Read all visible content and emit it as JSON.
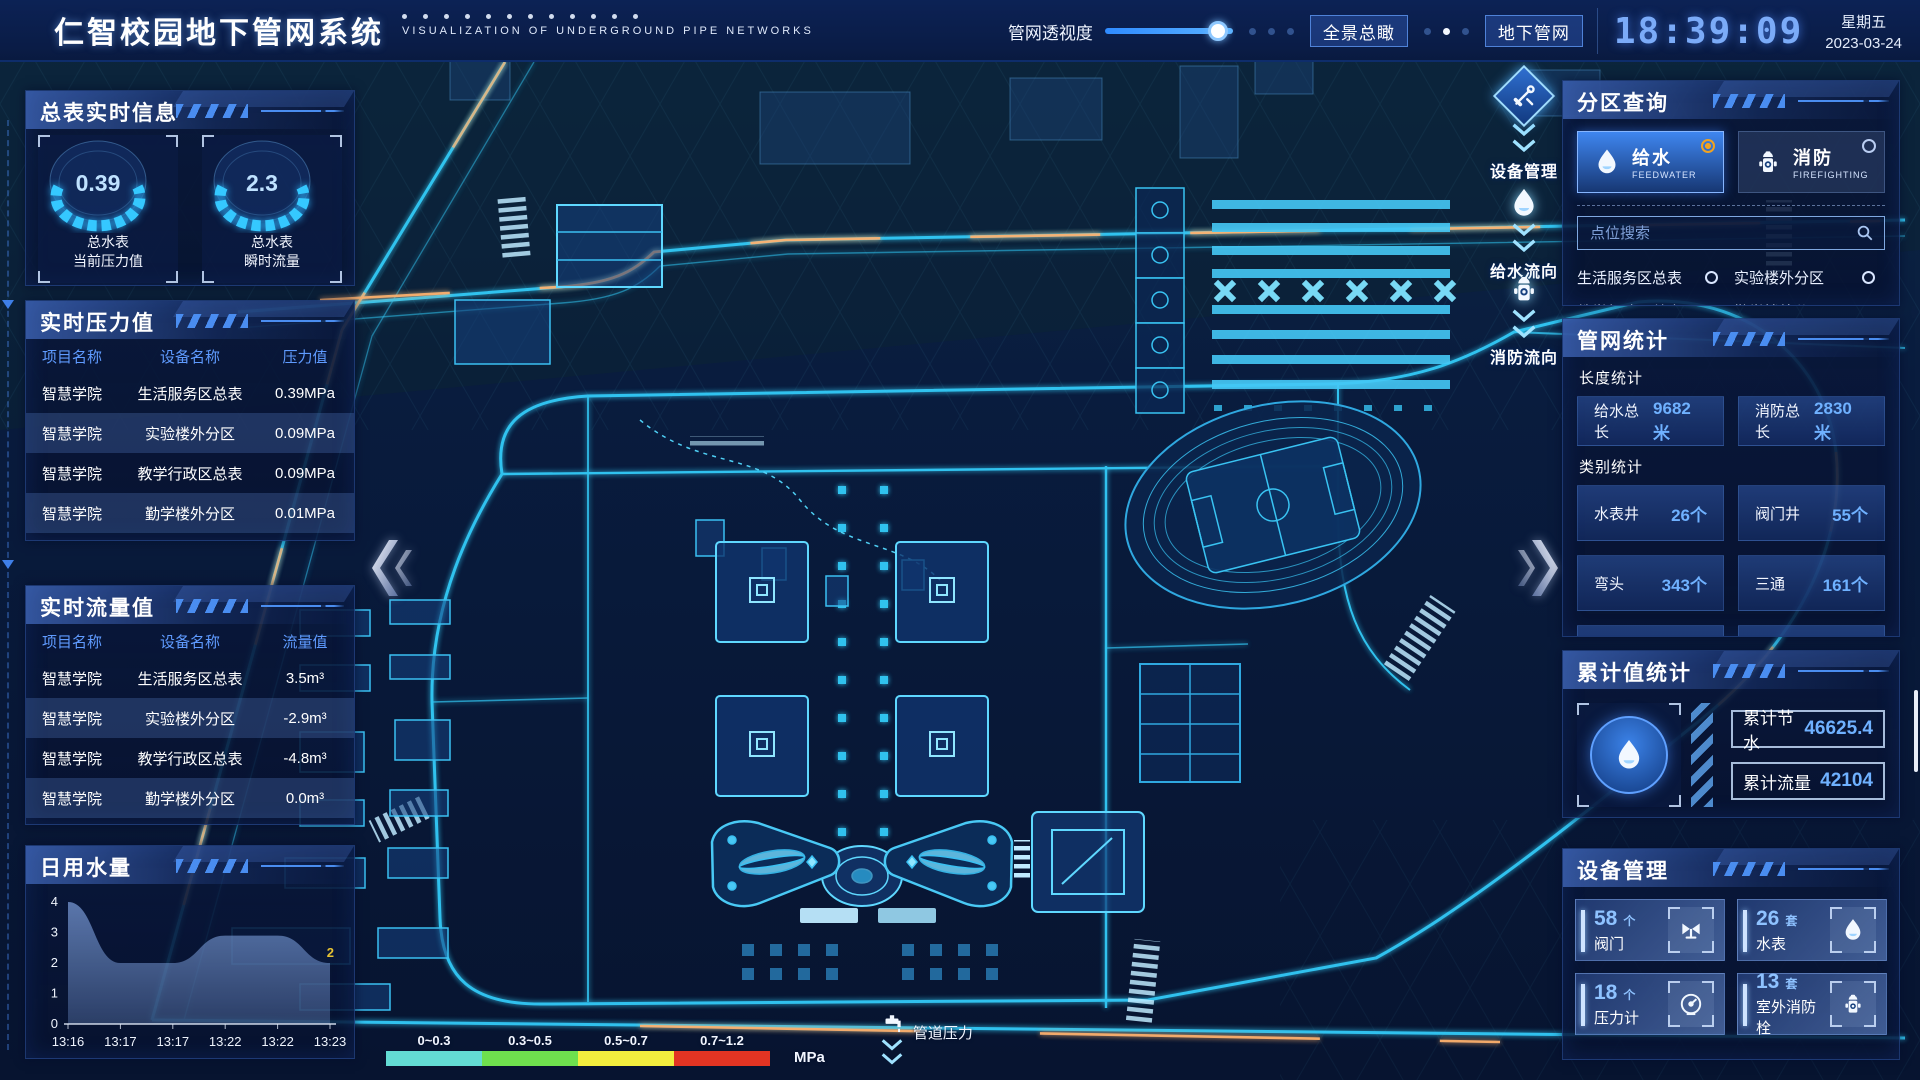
{
  "header": {
    "title": "仁智校园地下管网系统",
    "subtitle": "VISUALIZATION OF UNDERGROUND PIPE NETWORKS",
    "slider": {
      "label": "管网透视度",
      "percent": 88
    },
    "buttons": [
      {
        "label": "全景总瞰"
      },
      {
        "label": "地下管网"
      }
    ],
    "time": "18:39:09",
    "weekday": "星期五",
    "date": "2023-03-24"
  },
  "left": {
    "realtime_info": {
      "title": "总表实时信息",
      "gauges": [
        {
          "value": "0.39",
          "label1": "总水表",
          "label2": "当前压力值"
        },
        {
          "value": "2.3",
          "label1": "总水表",
          "label2": "瞬时流量"
        }
      ]
    },
    "pressure": {
      "title": "实时压力值",
      "headers": [
        "项目名称",
        "设备名称",
        "压力值"
      ],
      "rows": [
        [
          "智慧学院",
          "生活服务区总表",
          "0.39MPa"
        ],
        [
          "智慧学院",
          "实验楼外分区",
          "0.09MPa"
        ],
        [
          "智慧学院",
          "教学行政区总表",
          "0.09MPa"
        ],
        [
          "智慧学院",
          "勤学楼外分区",
          "0.01MPa"
        ],
        [
          "智慧学院",
          "砺学楼外分区",
          "0.02MPa"
        ]
      ]
    },
    "flow": {
      "title": "实时流量值",
      "headers": [
        "项目名称",
        "设备名称",
        "流量值"
      ],
      "rows": [
        [
          "智慧学院",
          "生活服务区总表",
          "3.5m³"
        ],
        [
          "智慧学院",
          "实验楼外分区",
          "-2.9m³"
        ],
        [
          "智慧学院",
          "教学行政区总表",
          "-4.8m³"
        ],
        [
          "智慧学院",
          "勤学楼外分区",
          "0.0m³"
        ],
        [
          "智慧学院",
          "砺学楼外分区",
          "2.3m³"
        ]
      ]
    },
    "daily_usage": {
      "title": "日用水量"
    }
  },
  "chart_data": {
    "type": "area",
    "title": "日用水量",
    "x": [
      "13:16",
      "13:17",
      "13:17",
      "13:22",
      "13:22",
      "13:23"
    ],
    "values": [
      4,
      2,
      2,
      2.9,
      2.9,
      2
    ],
    "ylim": [
      0,
      4
    ],
    "yticks": [
      0,
      1,
      2,
      3,
      4
    ],
    "grid": false,
    "end_label": "2",
    "end_label_color": "#e6c233",
    "area_color": "#6f8fc9"
  },
  "right": {
    "zone_query": {
      "title": "分区查询",
      "tabs": [
        {
          "label": "给水",
          "sub": "FEEDWATER",
          "icon": "water-drop",
          "active": true
        },
        {
          "label": "消防",
          "sub": "FIREFIGHTING",
          "icon": "hydrant",
          "active": false
        }
      ],
      "search_placeholder": "点位搜索",
      "items": [
        "生活服务区总表",
        "实验楼外分区",
        "教学行政区总表",
        "勤学楼外分区",
        "砺学楼外分区",
        "宿舍区泵房"
      ]
    },
    "pipe_stats": {
      "title": "管网统计",
      "length_title": "长度统计",
      "length_stats": [
        {
          "label": "给水总长",
          "value": "9682米"
        },
        {
          "label": "消防总长",
          "value": "2830米"
        }
      ],
      "category_title": "类别统计",
      "category_stats": [
        {
          "label": "水表井",
          "value": "26个"
        },
        {
          "label": "阀门井",
          "value": "55个"
        },
        {
          "label": "弯头",
          "value": "343个"
        },
        {
          "label": "三通",
          "value": "161个"
        },
        {
          "label": "",
          "value": ""
        },
        {
          "label": "",
          "value": ""
        }
      ]
    },
    "cumulative": {
      "title": "累计值统计",
      "icon": "water-drop",
      "rows": [
        {
          "label": "累计节水",
          "value": "46625.4"
        },
        {
          "label": "累计流量",
          "value": "42104"
        }
      ]
    },
    "devices": {
      "title": "设备管理",
      "cards": [
        {
          "count": "58",
          "unit": "个",
          "label": "阀门",
          "icon": "valve"
        },
        {
          "count": "26",
          "unit": "套",
          "label": "水表",
          "icon": "water-drop"
        },
        {
          "count": "18",
          "unit": "个",
          "label": "压力计",
          "icon": "pressure-gauge"
        },
        {
          "count": "13",
          "unit": "套",
          "label": "室外消防栓",
          "icon": "hydrant"
        }
      ]
    }
  },
  "map": {
    "overlays": [
      {
        "icon": "tools",
        "label": "设备管理"
      },
      {
        "icon": "water-drop",
        "label": "给水流向"
      },
      {
        "icon": "hydrant",
        "label": "消防流向"
      }
    ],
    "legend": {
      "ranges": [
        {
          "label": "0~0.3",
          "color": "#63dcd4"
        },
        {
          "label": "0.3~0.5",
          "color": "#6ee04e"
        },
        {
          "label": "0.5~0.7",
          "color": "#f2ee3e"
        },
        {
          "label": "0.7~1.2",
          "color": "#e23423"
        }
      ],
      "unit": "MPa",
      "pipe_label": "管道压力"
    }
  }
}
